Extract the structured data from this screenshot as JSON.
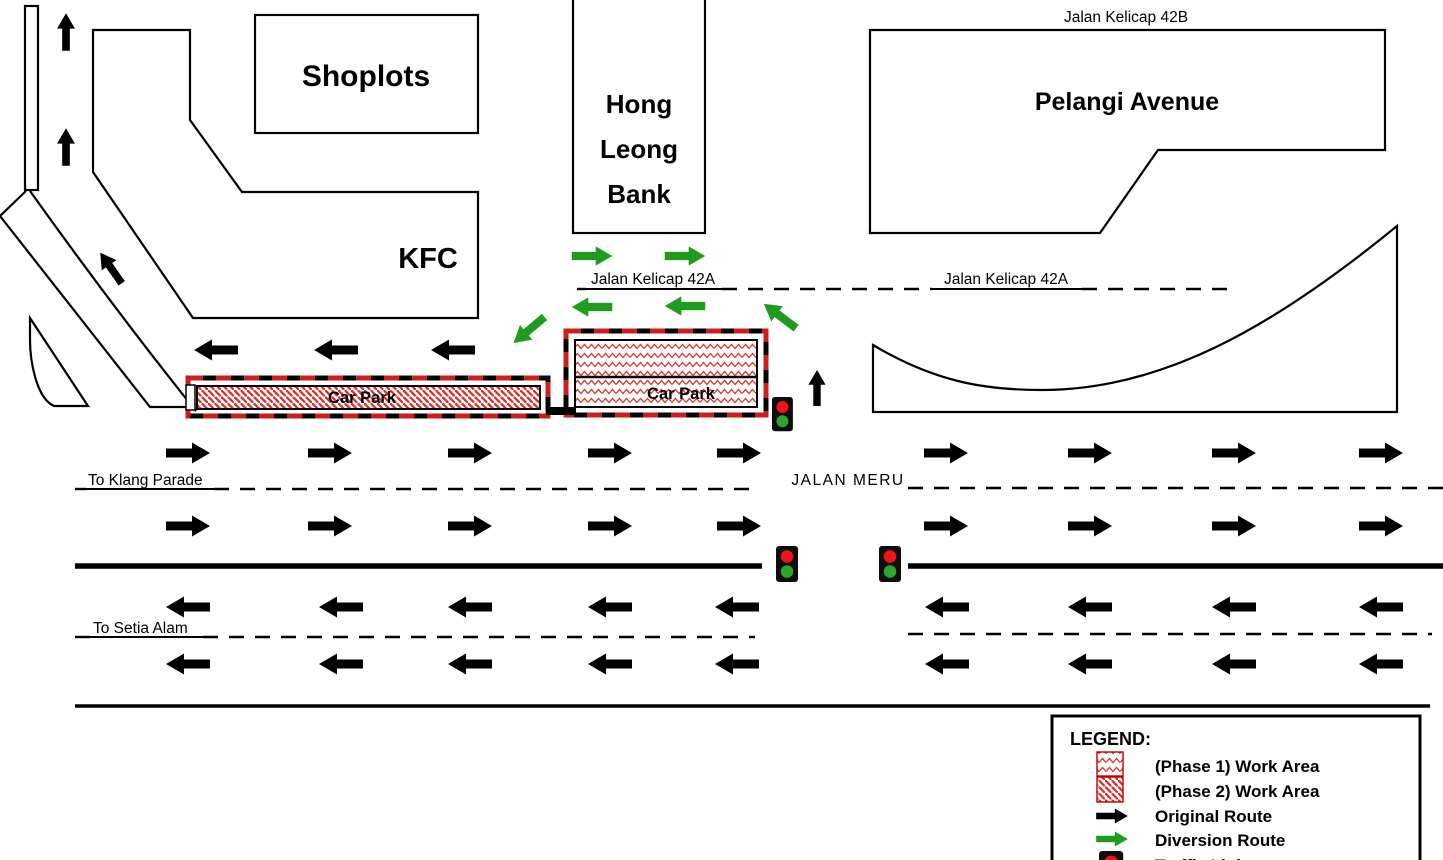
{
  "colors": {
    "work_area_red": "#D8322E",
    "dash_red": "#CF1D1D",
    "route_black": "#000000",
    "diversion_green": "#1E9C1E",
    "signal_red": "#F01414",
    "signal_green": "#2BA52B"
  },
  "buildings": {
    "shoplots": "Shoplots",
    "hong_leong_bank": {
      "line1": "Hong",
      "line2": "Leong",
      "line3": "Bank"
    },
    "kfc": "KFC",
    "pelangi_avenue": "Pelangi Avenue"
  },
  "roads": {
    "jalan_kelicap_42b": "Jalan Kelicap 42B",
    "jalan_kelicap_42a_left": "Jalan Kelicap 42A",
    "jalan_kelicap_42a_right": "Jalan Kelicap 42A",
    "jalan_meru": "JALAN MERU",
    "to_klang_parade": "To Klang Parade",
    "to_setia_alam": "To Setia Alam"
  },
  "work_areas": {
    "car_park_west": "Car Park",
    "car_park_east": "Car Park"
  },
  "legend": {
    "title": "LEGEND:",
    "items": [
      {
        "key": "phase1-work-area",
        "label": "(Phase 1) Work Area"
      },
      {
        "key": "phase2-work-area",
        "label": "(Phase 2) Work Area"
      },
      {
        "key": "original-route",
        "label": "Original Route"
      },
      {
        "key": "diversion-route",
        "label": "Diversion Route"
      },
      {
        "key": "traffic-light",
        "label": "Traffic Light"
      }
    ]
  }
}
